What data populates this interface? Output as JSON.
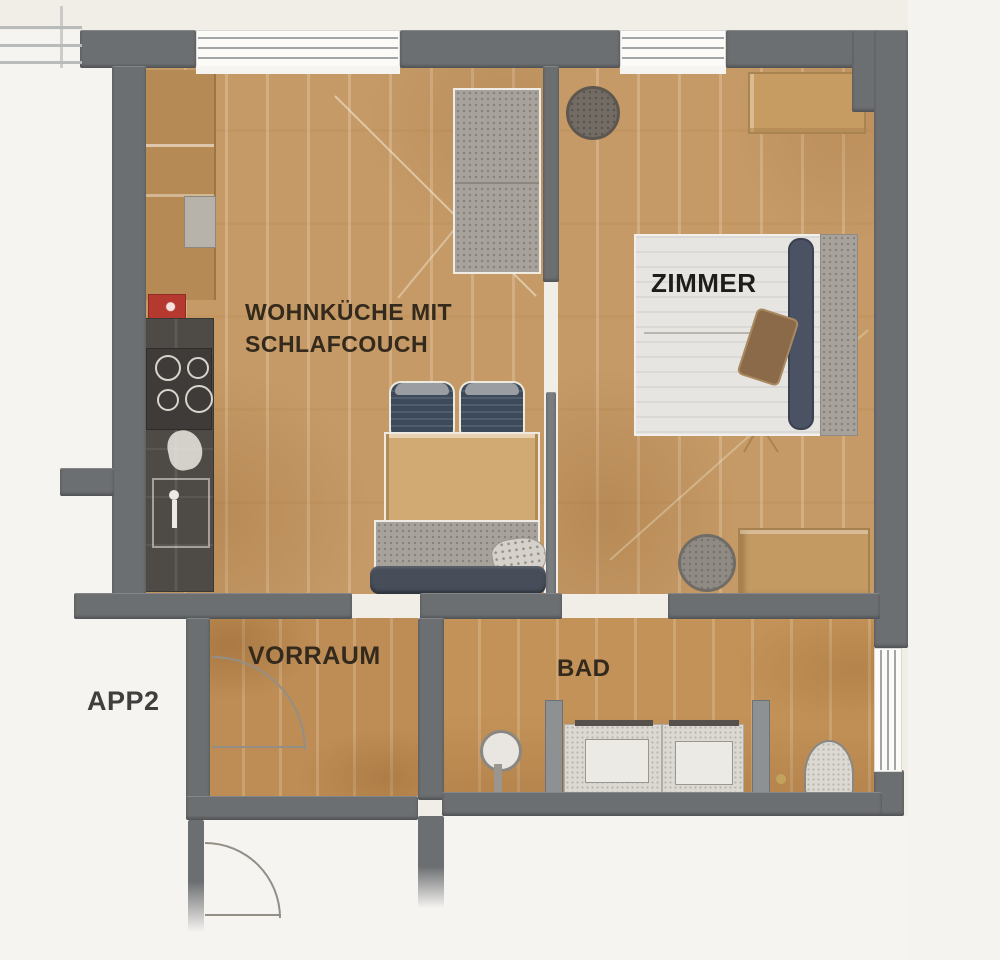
{
  "plan": {
    "apartment_label": "APP2",
    "rooms": {
      "living": {
        "label_line1": "WOHNKÜCHE MIT",
        "label_line2": "SCHLAFCOUCH"
      },
      "bedroom": {
        "label": "ZIMMER"
      },
      "hall": {
        "label": "VORRAUM"
      },
      "bath": {
        "label": "BAD"
      }
    },
    "colors": {
      "background": "#f1eee8",
      "wall_gray": "#6c6f71",
      "floor_wood": "#c59a66",
      "floor_hall_wood": "#bd8d55",
      "kitchen_counter_dark": "#4e4a46",
      "kitchen_counter_wood": "#b68a55",
      "kitchen_accent_red": "#b5392e",
      "sofa_gray": "#a7a29b",
      "chair_navy": "#3d4a5c",
      "bed_white": "#e7e5e1",
      "bed_runner_navy": "#4b5264",
      "cushion_brown": "#8a6a48",
      "table_wood": "#d0aa72",
      "label_text": "#33291c"
    }
  }
}
